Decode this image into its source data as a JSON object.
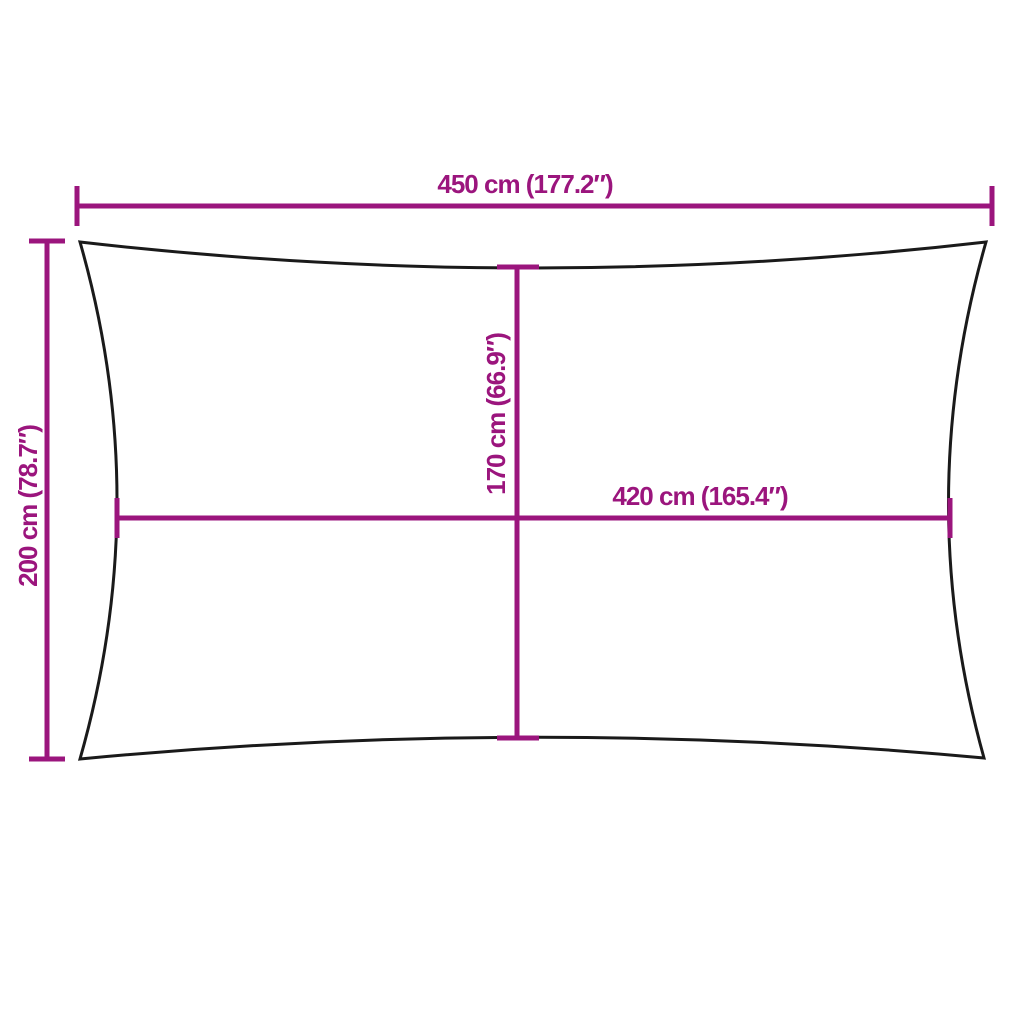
{
  "diagram": {
    "title": "shade-sail-dimension-diagram",
    "labels": {
      "top_width": "450 cm (177.2″)",
      "left_height": "200 cm (78.7″)",
      "center_height": "170 cm (66.9″)",
      "center_width": "420 cm (165.4″)"
    },
    "colors": {
      "dimension_accent": "#9B157D",
      "outline": "#1A1A1A",
      "background": "#FFFFFF"
    }
  }
}
